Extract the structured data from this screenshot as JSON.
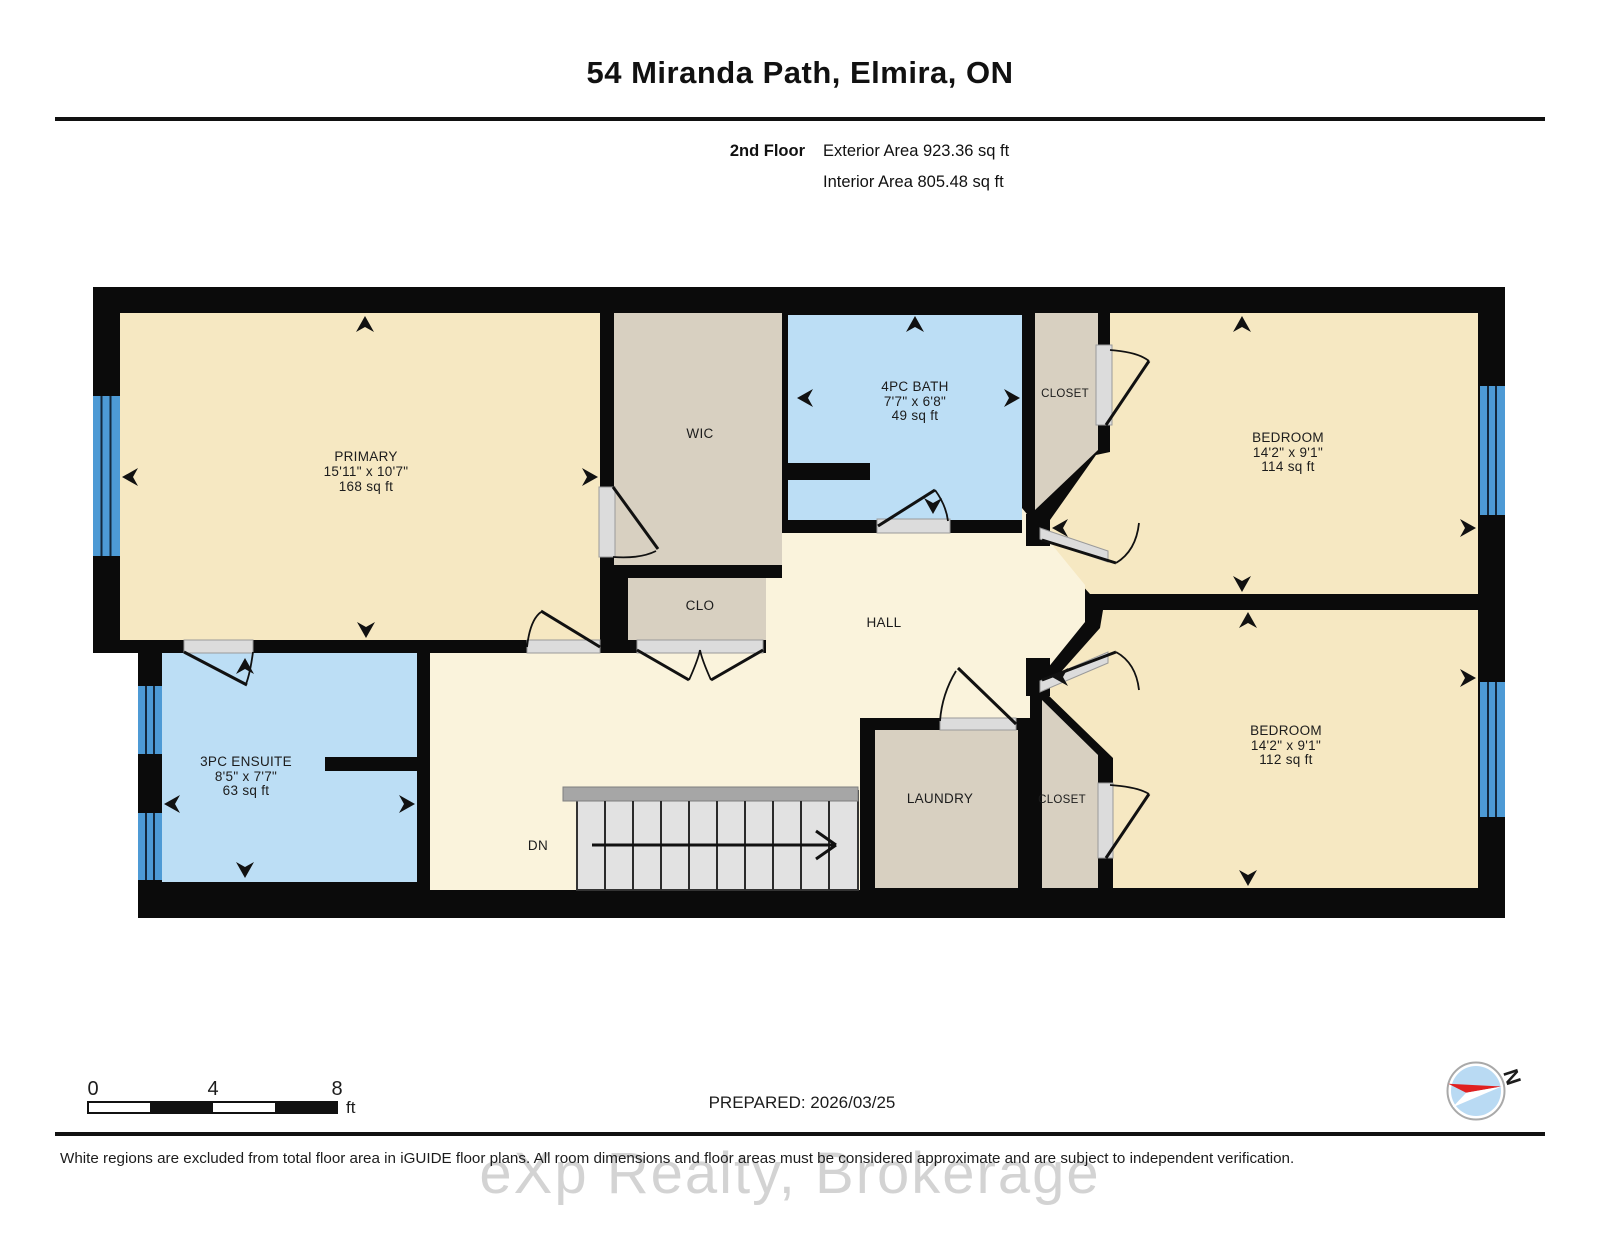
{
  "header": {
    "title": "54 Miranda Path, Elmira, ON",
    "floor_label": "2nd Floor",
    "exterior_area": "Exterior Area 923.36 sq ft",
    "interior_area": "Interior Area 805.48 sq ft"
  },
  "rooms": {
    "primary": {
      "name": "PRIMARY",
      "dim": "15'11\" x 10'7\"",
      "area": "168 sq ft"
    },
    "wic": {
      "name": "WIC"
    },
    "bath": {
      "name": "4PC BATH",
      "dim": "7'7\" x 6'8\"",
      "area": "49 sq ft"
    },
    "closet_top": {
      "name": "CLOSET"
    },
    "bedroom_top": {
      "name": "BEDROOM",
      "dim": "14'2\" x 9'1\"",
      "area": "114 sq ft"
    },
    "clo": {
      "name": "CLO"
    },
    "hall": {
      "name": "HALL"
    },
    "ensuite": {
      "name": "3PC ENSUITE",
      "dim": "8'5\" x 7'7\"",
      "area": "63 sq ft"
    },
    "laundry": {
      "name": "LAUNDRY"
    },
    "closet_bottom": {
      "name": "CLOSET"
    },
    "bedroom_bottom": {
      "name": "BEDROOM",
      "dim": "14'2\" x 9'1\"",
      "area": "112 sq ft"
    },
    "stairs": {
      "label": "DN"
    }
  },
  "footer": {
    "scale_ticks": [
      "0",
      "4",
      "8"
    ],
    "scale_unit": "ft",
    "prepared": "PREPARED: 2026/03/25",
    "compass_north": "N",
    "disclaimer": "White regions are excluded from total floor area in iGUIDE floor plans. All room dimensions and floor areas must be considered approximate and are subject to independent verification.",
    "watermark": "eXp Realty, Brokerage"
  },
  "colors": {
    "wall": "#0b0b0b",
    "room": "#f6e8c2",
    "hall": "#faf3dc",
    "utility": "#d8d0c1",
    "wet": "#bcdef5",
    "window": "#4d9ad5",
    "stairs": "#e2e2e2",
    "leaf": "#dcdcdc"
  }
}
